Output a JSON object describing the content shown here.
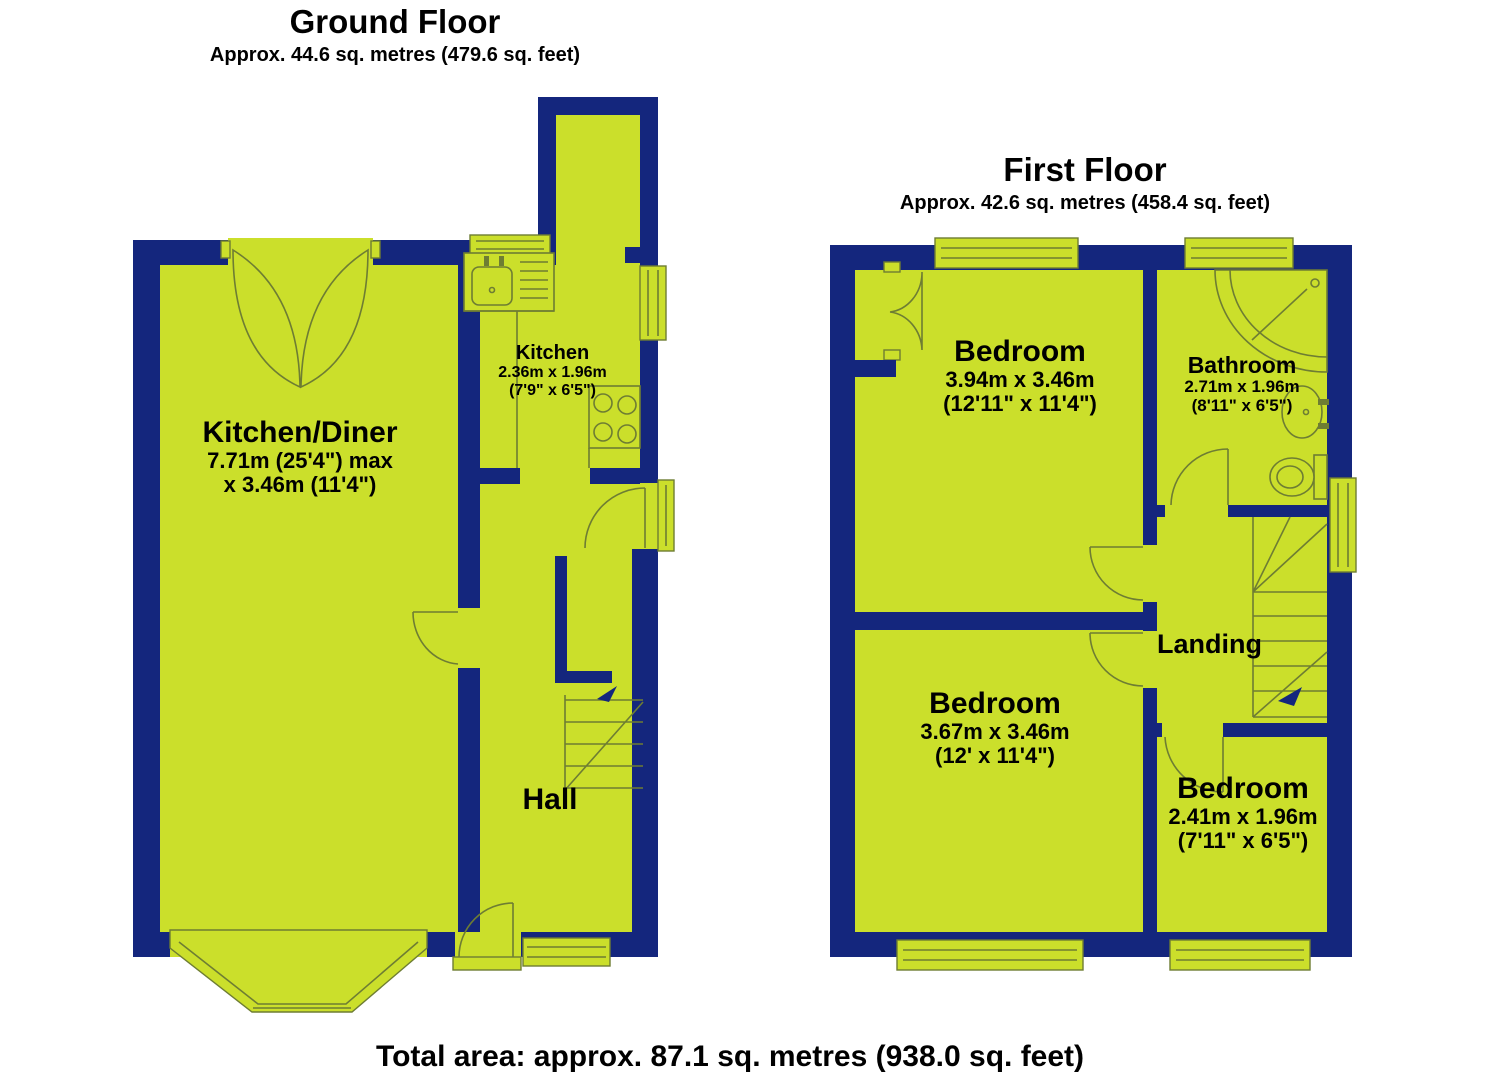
{
  "ground_floor": {
    "title": "Ground Floor",
    "subtitle": "Approx. 44.6 sq. metres (479.6 sq. feet)",
    "rooms": [
      {
        "name": "Kitchen/Diner",
        "dims": [
          "7.71m (25'4\") max",
          "x 3.46m (11'4\")"
        ]
      },
      {
        "name": "Kitchen",
        "dims": [
          "2.36m x 1.96m",
          "(7'9\" x 6'5\")"
        ]
      },
      {
        "name": "Hall",
        "dims": []
      }
    ]
  },
  "first_floor": {
    "title": "First Floor",
    "subtitle": "Approx. 42.6 sq. metres (458.4 sq. feet)",
    "rooms": [
      {
        "name": "Bedroom",
        "dims": [
          "3.94m x 3.46m",
          "(12'11\" x 11'4\")"
        ]
      },
      {
        "name": "Bathroom",
        "dims": [
          "2.71m x 1.96m",
          "(8'11\" x 6'5\")"
        ]
      },
      {
        "name": "Bedroom",
        "dims": [
          "3.67m x 3.46m",
          "(12' x 11'4\")"
        ]
      },
      {
        "name": "Bedroom",
        "dims": [
          "2.41m x 1.96m",
          "(7'11\" x 6'5\")"
        ]
      },
      {
        "name": "Landing",
        "dims": []
      }
    ]
  },
  "footer": {
    "total_area": "Total area: approx. 87.1 sq. metres (938.0 sq. feet)"
  },
  "colors": {
    "wall": "#14267d",
    "floor": "#cbdf2b",
    "line": "#6e7d33"
  }
}
